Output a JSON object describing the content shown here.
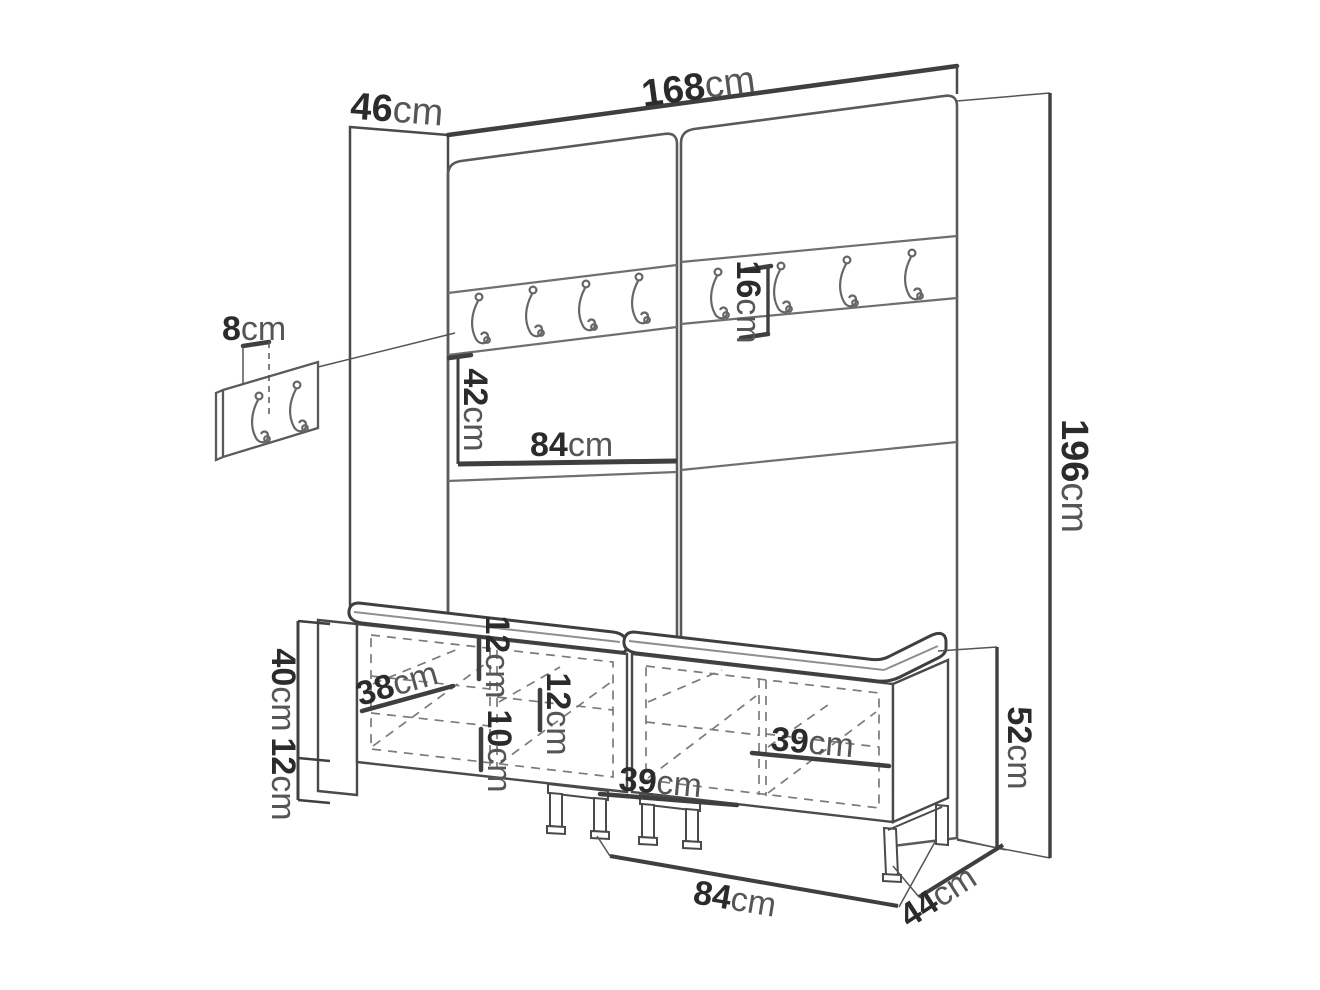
{
  "diagram": {
    "kind": "furniture dimension drawing",
    "unit_suffix": "cm",
    "hook_count_main_row": 8,
    "hook_count_wall_panel": 2,
    "bench_count": 2
  },
  "dimensions": {
    "top_width": {
      "num": "168",
      "unit": "cm"
    },
    "top_depth": {
      "num": "46",
      "unit": "cm"
    },
    "total_height": {
      "num": "196",
      "unit": "cm"
    },
    "wall_hook_offset": {
      "num": "8",
      "unit": "cm"
    },
    "hook_row_height": {
      "num": "16",
      "unit": "cm"
    },
    "mid_section_height": {
      "num": "42",
      "unit": "cm"
    },
    "panel_half_width": {
      "num": "84",
      "unit": "cm"
    },
    "bench_body_height": {
      "num": "40",
      "unit": "cm"
    },
    "bench_leg_height": {
      "num": "12",
      "unit": "cm"
    },
    "bench_inner_depth": {
      "num": "38",
      "unit": "cm"
    },
    "shelf_gap_upper": {
      "num": "12",
      "unit": "cm"
    },
    "shelf_gap_lower": {
      "num": "10",
      "unit": "cm"
    },
    "shelf_gap_right": {
      "num": "12",
      "unit": "cm"
    },
    "compartment_left": {
      "num": "39",
      "unit": "cm"
    },
    "compartment_right": {
      "num": "39",
      "unit": "cm"
    },
    "bench_total_height": {
      "num": "52",
      "unit": "cm"
    },
    "bench_width": {
      "num": "84",
      "unit": "cm"
    },
    "bench_depth": {
      "num": "44",
      "unit": "cm"
    }
  },
  "colors": {
    "background": "#ffffff",
    "line_main": "#3f3f3f",
    "line_secondary": "#6f6f6f",
    "line_dashed": "#7a7a7a",
    "number_text": "#2b2b2b",
    "unit_text": "#565656"
  }
}
